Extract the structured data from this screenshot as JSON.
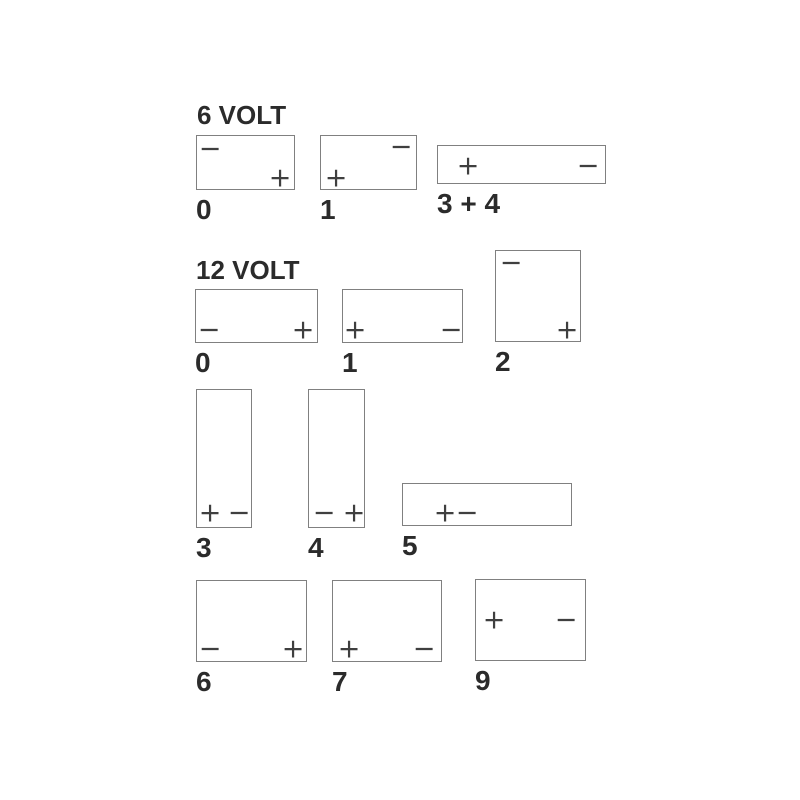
{
  "page": {
    "background": "#ffffff",
    "box_border_color": "#808080",
    "symbol_color": "#3f3f3f",
    "text_color": "#2b2b2b"
  },
  "headings": {
    "v6": "6 VOLT",
    "v12": "12 VOLT"
  },
  "symbols": {
    "plus": "+",
    "minus": "−"
  },
  "batteries": [
    {
      "id": "6v-0",
      "voltage": "6 VOLT",
      "label": "0",
      "box": {
        "x": 196,
        "y": 135,
        "w": 99,
        "h": 55
      },
      "terminals": [
        {
          "type": "minus",
          "x": 13,
          "y": 13
        },
        {
          "type": "plus",
          "x": 83,
          "y": 42
        }
      ]
    },
    {
      "id": "6v-1",
      "voltage": "6 VOLT",
      "label": "1",
      "box": {
        "x": 320,
        "y": 135,
        "w": 97,
        "h": 55
      },
      "terminals": [
        {
          "type": "plus",
          "x": 15,
          "y": 42
        },
        {
          "type": "minus",
          "x": 80,
          "y": 11
        }
      ]
    },
    {
      "id": "6v-3-4",
      "voltage": "6 VOLT",
      "label": "3 + 4",
      "box": {
        "x": 437,
        "y": 145,
        "w": 169,
        "h": 39
      },
      "terminals": [
        {
          "type": "plus",
          "x": 30,
          "y": 20
        },
        {
          "type": "minus",
          "x": 150,
          "y": 20
        }
      ]
    },
    {
      "id": "12v-0",
      "voltage": "12 VOLT",
      "label": "0",
      "box": {
        "x": 195,
        "y": 289,
        "w": 123,
        "h": 54
      },
      "terminals": [
        {
          "type": "minus",
          "x": 13,
          "y": 40
        },
        {
          "type": "plus",
          "x": 107,
          "y": 40
        }
      ]
    },
    {
      "id": "12v-1",
      "voltage": "12 VOLT",
      "label": "1",
      "box": {
        "x": 342,
        "y": 289,
        "w": 121,
        "h": 54
      },
      "terminals": [
        {
          "type": "plus",
          "x": 12,
          "y": 40
        },
        {
          "type": "minus",
          "x": 108,
          "y": 40
        }
      ]
    },
    {
      "id": "12v-2",
      "voltage": "12 VOLT",
      "label": "2",
      "box": {
        "x": 495,
        "y": 250,
        "w": 86,
        "h": 92
      },
      "terminals": [
        {
          "type": "minus",
          "x": 15,
          "y": 12
        },
        {
          "type": "plus",
          "x": 71,
          "y": 79
        }
      ]
    },
    {
      "id": "12v-3",
      "voltage": "12 VOLT",
      "label": "3",
      "box": {
        "x": 196,
        "y": 389,
        "w": 56,
        "h": 139
      },
      "terminals": [
        {
          "type": "plus",
          "x": 13,
          "y": 123
        },
        {
          "type": "minus",
          "x": 42,
          "y": 123
        }
      ]
    },
    {
      "id": "12v-4",
      "voltage": "12 VOLT",
      "label": "4",
      "box": {
        "x": 308,
        "y": 389,
        "w": 57,
        "h": 139
      },
      "terminals": [
        {
          "type": "minus",
          "x": 15,
          "y": 123
        },
        {
          "type": "plus",
          "x": 45,
          "y": 123
        }
      ]
    },
    {
      "id": "12v-5",
      "voltage": "12 VOLT",
      "label": "5",
      "box": {
        "x": 402,
        "y": 483,
        "w": 170,
        "h": 43
      },
      "terminals": [
        {
          "type": "plus",
          "x": 42,
          "y": 29
        },
        {
          "type": "minus",
          "x": 64,
          "y": 29
        }
      ]
    },
    {
      "id": "12v-6",
      "voltage": "12 VOLT",
      "label": "6",
      "box": {
        "x": 196,
        "y": 580,
        "w": 111,
        "h": 82
      },
      "terminals": [
        {
          "type": "minus",
          "x": 13,
          "y": 68
        },
        {
          "type": "plus",
          "x": 96,
          "y": 68
        }
      ]
    },
    {
      "id": "12v-7",
      "voltage": "12 VOLT",
      "label": "7",
      "box": {
        "x": 332,
        "y": 580,
        "w": 110,
        "h": 82
      },
      "terminals": [
        {
          "type": "plus",
          "x": 16,
          "y": 68
        },
        {
          "type": "minus",
          "x": 91,
          "y": 68
        }
      ]
    },
    {
      "id": "12v-9",
      "voltage": "12 VOLT",
      "label": "9",
      "box": {
        "x": 475,
        "y": 579,
        "w": 111,
        "h": 82
      },
      "terminals": [
        {
          "type": "plus",
          "x": 18,
          "y": 40
        },
        {
          "type": "minus",
          "x": 90,
          "y": 40
        }
      ]
    }
  ]
}
